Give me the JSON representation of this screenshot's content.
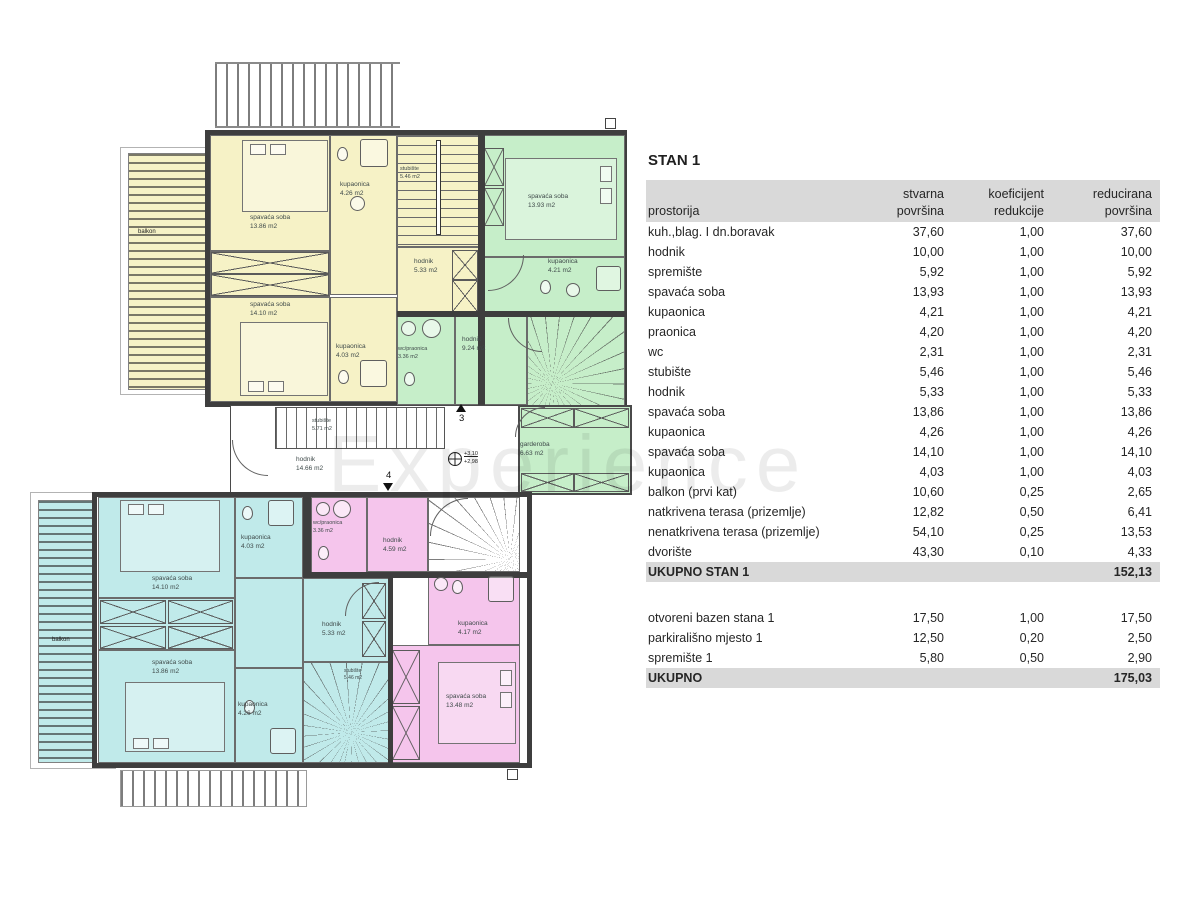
{
  "title": "STAN 1",
  "watermark": "Experience",
  "table": {
    "headers": {
      "col1": "prostorija",
      "col2_line1": "stvarna",
      "col2_line2": "površina",
      "col3_line1": "koeficijent",
      "col3_line2": "redukcije",
      "col4_line1": "reducirana",
      "col4_line2": "površina"
    },
    "rows": [
      {
        "name": "kuh.,blag. I dn.boravak",
        "actual": "37,60",
        "coef": "1,00",
        "reduced": "37,60"
      },
      {
        "name": "hodnik",
        "actual": "10,00",
        "coef": "1,00",
        "reduced": "10,00"
      },
      {
        "name": "spremište",
        "actual": "5,92",
        "coef": "1,00",
        "reduced": "5,92"
      },
      {
        "name": "spavaća soba",
        "actual": "13,93",
        "coef": "1,00",
        "reduced": "13,93"
      },
      {
        "name": "kupaonica",
        "actual": "4,21",
        "coef": "1,00",
        "reduced": "4,21"
      },
      {
        "name": "praonica",
        "actual": "4,20",
        "coef": "1,00",
        "reduced": "4,20"
      },
      {
        "name": "wc",
        "actual": "2,31",
        "coef": "1,00",
        "reduced": "2,31"
      },
      {
        "name": "stubište",
        "actual": "5,46",
        "coef": "1,00",
        "reduced": "5,46"
      },
      {
        "name": "hodnik",
        "actual": "5,33",
        "coef": "1,00",
        "reduced": "5,33"
      },
      {
        "name": "spavaća soba",
        "actual": "13,86",
        "coef": "1,00",
        "reduced": "13,86"
      },
      {
        "name": "kupaonica",
        "actual": "4,26",
        "coef": "1,00",
        "reduced": "4,26"
      },
      {
        "name": "spavaća soba",
        "actual": "14,10",
        "coef": "1,00",
        "reduced": "14,10"
      },
      {
        "name": "kupaonica",
        "actual": "4,03",
        "coef": "1,00",
        "reduced": "4,03"
      },
      {
        "name": "balkon (prvi kat)",
        "actual": "10,60",
        "coef": "0,25",
        "reduced": "2,65"
      },
      {
        "name": "natkrivena terasa (prizemlje)",
        "actual": "12,82",
        "coef": "0,50",
        "reduced": "6,41"
      },
      {
        "name": "nenatkrivena terasa (prizemlje)",
        "actual": "54,10",
        "coef": "0,25",
        "reduced": "13,53"
      },
      {
        "name": "dvorište",
        "actual": "43,30",
        "coef": "0,10",
        "reduced": "4,33"
      }
    ],
    "subtotal": {
      "label": "UKUPNO STAN 1",
      "value": "152,13"
    },
    "extra_rows": [
      {
        "name": "otvoreni bazen stana 1",
        "actual": "17,50",
        "coef": "1,00",
        "reduced": "17,50"
      },
      {
        "name": "parkirališno mjesto 1",
        "actual": "12,50",
        "coef": "0,20",
        "reduced": "2,50"
      },
      {
        "name": "spremište 1",
        "actual": "5,80",
        "coef": "0,50",
        "reduced": "2,90"
      }
    ],
    "total": {
      "label": "UKUPNO",
      "value": "175,03"
    }
  },
  "plan": {
    "rooms": [
      {
        "name": "spavaća soba",
        "area": "13.86 m2"
      },
      {
        "name": "kupaonica",
        "area": "4.26 m2"
      },
      {
        "name": "stubište",
        "area": "5.46 m2"
      },
      {
        "name": "spavaća soba",
        "area": "13.93 m2"
      },
      {
        "name": "hodnik",
        "area": "5.33 m2"
      },
      {
        "name": "kupaonica",
        "area": "4.21 m2"
      },
      {
        "name": "spavaća soba",
        "area": "14.10 m2"
      },
      {
        "name": "kupaonica",
        "area": "4.03 m2"
      },
      {
        "name": "wc/praonica",
        "area": "3.36 m2"
      },
      {
        "name": "hodnik",
        "area": "9.24 m2"
      },
      {
        "name": "stubište",
        "area": "5.71 m2"
      },
      {
        "name": "hodnik",
        "area": "14.66 m2"
      },
      {
        "name": "garderoba",
        "area": "6.63 m2"
      },
      {
        "name": "kupaonica",
        "area": "4.03 m2"
      },
      {
        "name": "wc/praonica",
        "area": "3.36 m2"
      },
      {
        "name": "hodnik",
        "area": "4.59 m2"
      },
      {
        "name": "spavaća soba",
        "area": "14.10 m2"
      },
      {
        "name": "hodnik",
        "area": "5.33 m2"
      },
      {
        "name": "kupaonica",
        "area": "4.17 m2"
      },
      {
        "name": "spavaća soba",
        "area": "13.86 m2"
      },
      {
        "name": "kupaonica",
        "area": "4.26 m2"
      },
      {
        "name": "stubište",
        "area": "5.46 m2"
      },
      {
        "name": "spavaća soba",
        "area": "13.48 m2"
      },
      {
        "name": "balkon"
      },
      {
        "name": "balkon"
      }
    ],
    "markers": {
      "section_up": "3",
      "section_down": "4",
      "elevation_upper": "+3,10",
      "elevation_lower": "+2,98"
    },
    "colors": {
      "yellow": "#f6f2c6",
      "green": "#c6eec9",
      "cyan": "#c0eaea",
      "pink": "#f5c5ec",
      "wall": "#3e3e3e"
    }
  }
}
